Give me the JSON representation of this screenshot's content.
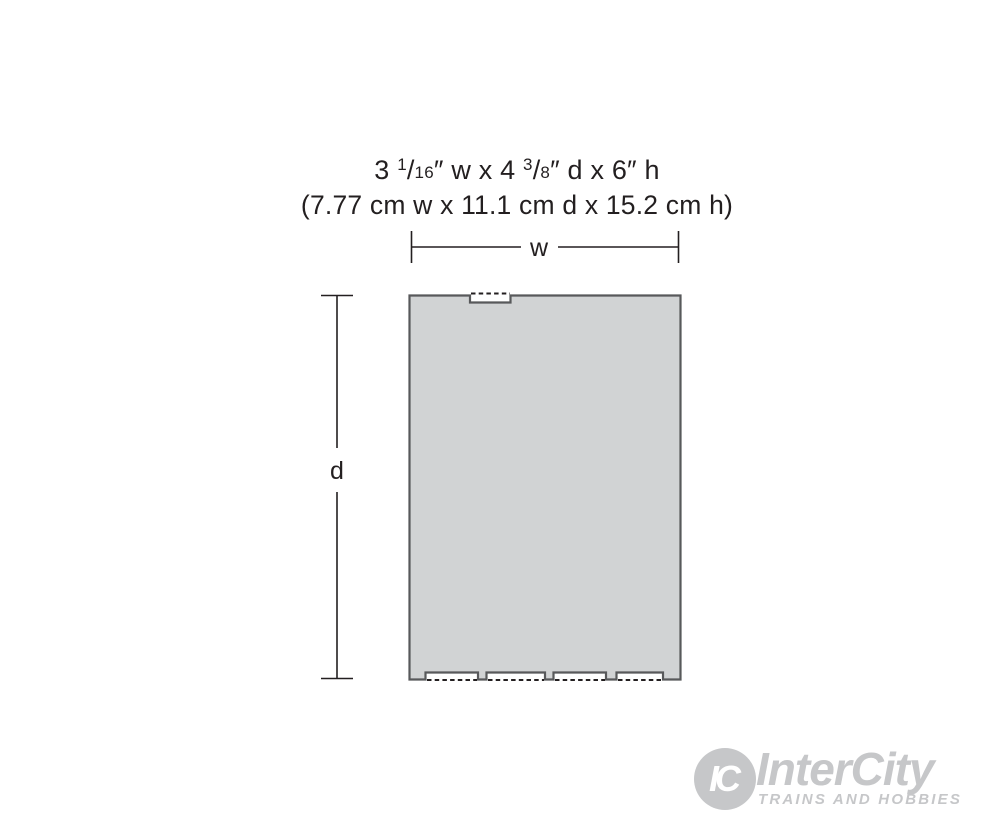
{
  "colors": {
    "box_fill": "#d1d3d4",
    "box_stroke": "#58595b",
    "line_color": "#231f20",
    "text_color": "#231f20",
    "logo_gray": "#c6c7c9"
  },
  "title": {
    "imperial_parts": [
      {
        "t": "3 ",
        "s": "n"
      },
      {
        "t": "1",
        "s": "sup"
      },
      {
        "t": "/",
        "s": "n"
      },
      {
        "t": "16",
        "s": "den"
      },
      {
        "t": "″ w x 4 ",
        "s": "n"
      },
      {
        "t": "3",
        "s": "sup"
      },
      {
        "t": "/",
        "s": "n"
      },
      {
        "t": "8",
        "s": "den"
      },
      {
        "t": "″ d x 6″ h",
        "s": "n"
      }
    ],
    "imperial_text": "3 1/16″ w x 4 3/8″ d x 6″ h",
    "metric_text": "(7.77 cm w x 11.1 cm d x 15.2 cm h)"
  },
  "dimension_labels": {
    "width": "w",
    "depth": "d"
  },
  "logo": {
    "monogram": "IC",
    "name": "InterCity",
    "tagline": "TRAINS AND HOBBIES"
  }
}
